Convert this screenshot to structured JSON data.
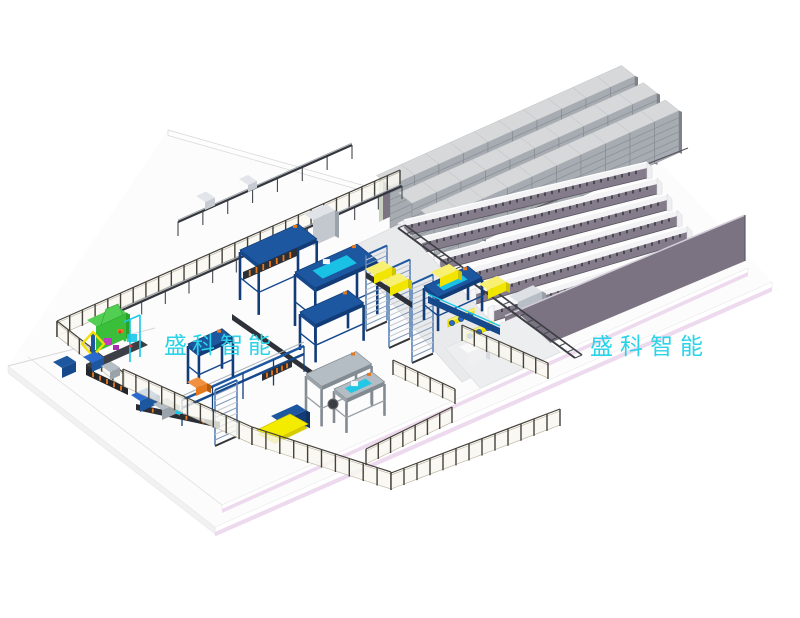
{
  "watermarks": {
    "left": {
      "text": "盛科智能"
    },
    "right": {
      "text": "盛科智能"
    }
  },
  "palette": {
    "background": "#ffffff",
    "platform_top": "#fcfcfc",
    "platform_edge_pink": "#eedaee",
    "platform_edge_line": "#d8d8d8",
    "wall_purple": "#7b7381",
    "wall_cap": "#d2ccd8",
    "rack_front": "#a7acb2",
    "rack_slat": "#8d9298",
    "rack_top": "#d6d8da",
    "rack_side": "#7e838a",
    "rail_face": "#847c8a",
    "rail_beam": "#f3f3f5",
    "rail_tick": "#24242a",
    "aisle_floor": "#e9eaec",
    "track_dark": "#3a3d42",
    "machine_blue": "#1d57a0",
    "machine_blue_dark": "#123c78",
    "machine_blue_mid": "#16488c",
    "steel": "#9aa2aa",
    "steel_light": "#b4bcc4",
    "cyan_accent": "#19c8e8",
    "orange": "#e5791e",
    "green": "#3abf3a",
    "green_light": "#52cf52",
    "magenta": "#c23cc2",
    "yellow": "#f2e600",
    "yellow_deep": "#cfc400",
    "wheel_blue": "#2a6ace",
    "fence_post": "#45423b",
    "fence_frame": "#b5ad97",
    "fence_panel": "rgba(248,246,239,0.82)",
    "watermark_cyan": "#2bd3e8"
  },
  "scene": {
    "storage_racks": {
      "rows": 3,
      "per_row": 10
    },
    "rail_lines": 7,
    "machine_names": [
      "green-hopper-machine",
      "dosing-unit",
      "palletizer-gantry-1",
      "palletizer-gantry-2",
      "stacker-gantry",
      "steel-frame-station",
      "steel-frame-station-2",
      "buffer-tower-1",
      "buffer-tower-2",
      "buffer-tower-3",
      "lift-tower",
      "roller-conveyor-1",
      "roller-conveyor-2",
      "transfer-conveyor",
      "infeed-line-upper",
      "infeed-line-lower",
      "pick-and-place-station",
      "shuttle-track",
      "shuttle-car-1",
      "shuttle-car-2",
      "yellow-pallet-plate",
      "pallet-stand",
      "pallet-box-1",
      "pallet-box-2",
      "pallet-box-3",
      "pallet-box-4",
      "control-cabinet-1",
      "control-cabinet-2",
      "outfeed-boxes"
    ]
  }
}
